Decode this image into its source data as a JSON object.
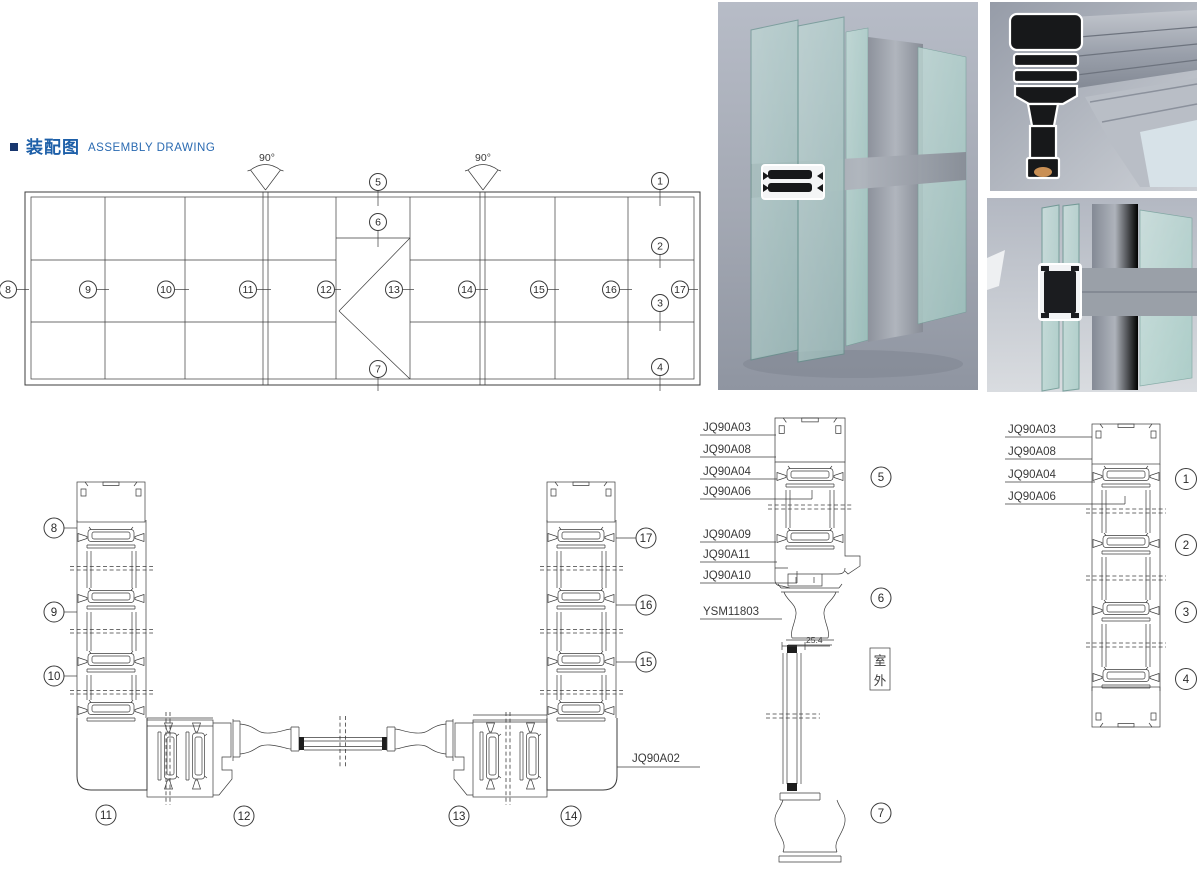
{
  "colors": {
    "accent_blue": "#1d5fa8",
    "bullet_navy": "#17366e",
    "drawing_line": "#3c3c3c",
    "glass_teal": "#a9cfc9",
    "aluminum_gray": "#9aa0ab"
  },
  "header": {
    "title_zh": "装配图",
    "title_en": "ASSEMBLY DRAWING"
  },
  "plan_view": {
    "angle_left": "90°",
    "angle_right": "90°",
    "callouts_row": [
      "8",
      "9",
      "10",
      "11",
      "12",
      "13",
      "14",
      "15",
      "16",
      "17"
    ],
    "callouts_center": [
      "5",
      "6",
      "7"
    ],
    "callouts_right": [
      "1",
      "2",
      "3",
      "4"
    ]
  },
  "horizontal_section": {
    "callouts_left": [
      "8",
      "9",
      "10"
    ],
    "callouts_right": [
      "17",
      "16",
      "15"
    ],
    "callouts_bottom": [
      "11",
      "12",
      "13",
      "14"
    ],
    "part_label": "JQ90A02"
  },
  "vertical_section_mid": {
    "part_labels": [
      "JQ90A03",
      "JQ90A08",
      "JQ90A04",
      "JQ90A06",
      "JQ90A09",
      "JQ90A11",
      "JQ90A10",
      "YSM11803"
    ],
    "callouts": [
      "5",
      "6",
      "7"
    ],
    "dimension": "25.4",
    "outdoor_label": {
      "full": "室外",
      "top": "室",
      "bottom": "外"
    }
  },
  "vertical_section_right": {
    "part_labels": [
      "JQ90A03",
      "JQ90A08",
      "JQ90A04",
      "JQ90A06"
    ],
    "callouts": [
      "1",
      "2",
      "3",
      "4"
    ]
  }
}
